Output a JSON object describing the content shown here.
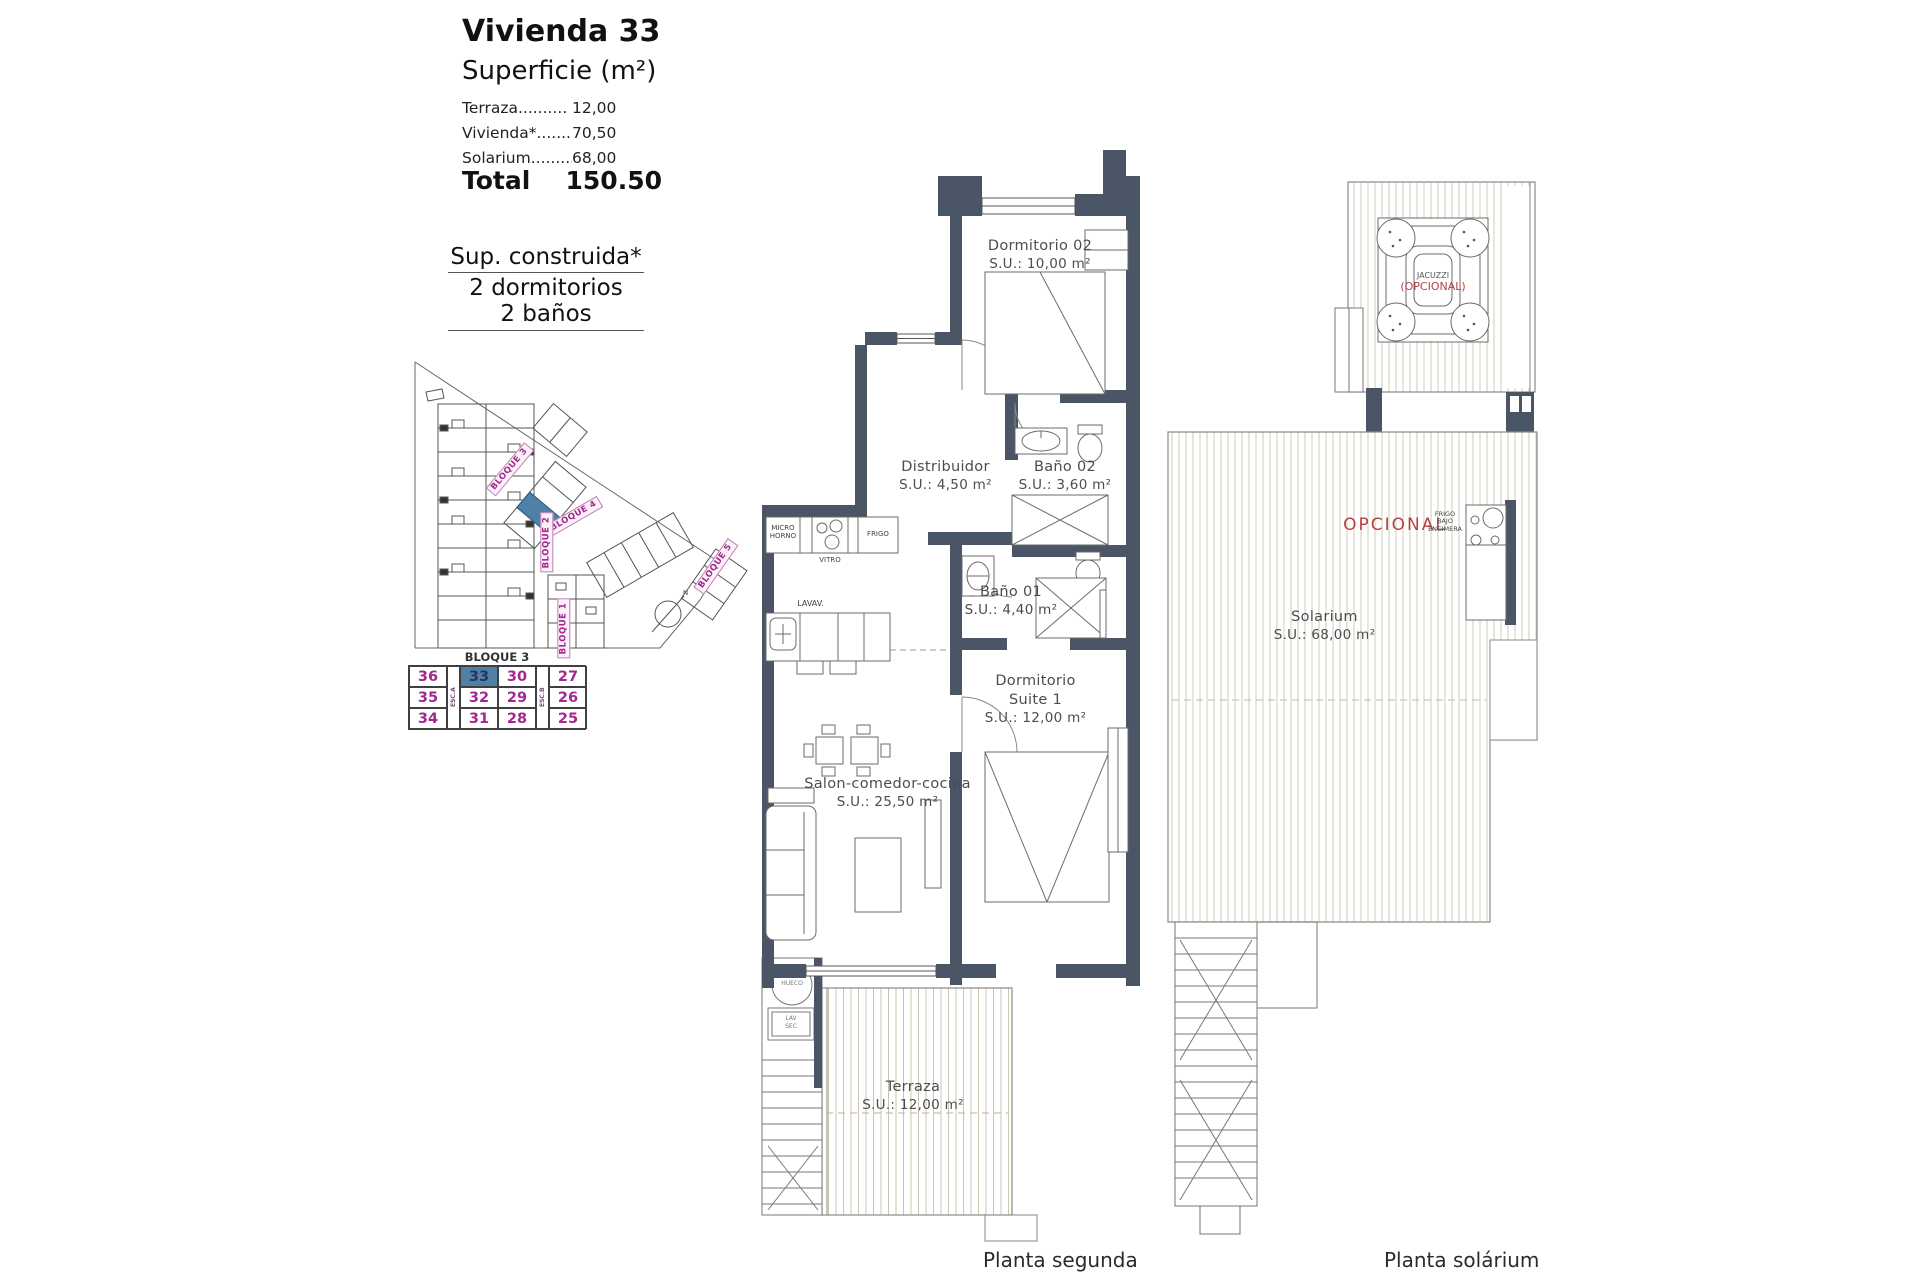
{
  "panel": {
    "title": "Vivienda 33",
    "subtitle": "Superficie (m²)",
    "surface_rows": [
      {
        "label": "Terraza..........",
        "value": "12,00"
      },
      {
        "label": "Vivienda*........",
        "value": "70,50"
      },
      {
        "label": "Solarium.........",
        "value": "68,00"
      }
    ],
    "total_label": "Total",
    "total_value": "150.50",
    "built_title": "Sup. construida*",
    "built_line1": "2 dormitorios",
    "built_line2": "2 baños"
  },
  "site_plan": {
    "block_labels": {
      "b3": "BLOQUE 3",
      "b4": "BLOQUE 4",
      "b5": "BLOQUE 5",
      "b2": "BLOQUE 2",
      "b1": "BLOQUE 1"
    },
    "north": "N",
    "highlighted_block": "BLOQUE 3"
  },
  "block_table": {
    "title": "BLOQUE 3",
    "stair_a": "ESC.A",
    "stair_b": "ESC.B",
    "rows": [
      [
        "36",
        "33",
        "30",
        "27"
      ],
      [
        "35",
        "32",
        "29",
        "26"
      ],
      [
        "34",
        "31",
        "28",
        "25"
      ]
    ],
    "highlighted_unit": "33"
  },
  "planta_segunda": {
    "caption": "Planta segunda",
    "rooms": {
      "dormitorio02": {
        "name": "Dormitorio 02",
        "area": "S.U.: 10,00 m²"
      },
      "distribuidor": {
        "name": "Distribuidor",
        "area": "S.U.: 4,50 m²"
      },
      "bano02": {
        "name": "Baño 02",
        "area": "S.U.: 3,60 m²"
      },
      "bano01": {
        "name": "Baño 01",
        "area": "S.U.: 4,40 m²"
      },
      "suite": {
        "name": "Dormitorio Suite 1",
        "area": "S.U.: 12,00 m²"
      },
      "salon": {
        "name": "Salon-comedor-cocina",
        "area": "S.U.: 25,50 m²"
      },
      "terraza": {
        "name": "Terraza",
        "area": "S.U.: 12,00 m²"
      }
    },
    "appliances": {
      "micro": "MICRO HORNO",
      "vitro": "VITRO",
      "frigo": "FRIGO",
      "lavav": "LAVAV.",
      "hueco": "HUECO",
      "lav": "LAV",
      "sec": "SEC"
    }
  },
  "planta_solarium": {
    "caption": "Planta solárium",
    "room": {
      "name": "Solarium",
      "area": "S.U.: 68,00 m²"
    },
    "jacuzzi_label": "JACUZZI",
    "jacuzzi_optional": "(OPCIONAL)",
    "optional_label": "OPCIONAL",
    "kitchenette_label": "FRIGO BAJO ENCIMERA"
  },
  "colors": {
    "wall": "#4a5565",
    "highlight_blue": "#4e80a8",
    "magenta": "#a3278f",
    "optional_red": "#b5413f",
    "deck_stripe": "#ccc5ae"
  }
}
